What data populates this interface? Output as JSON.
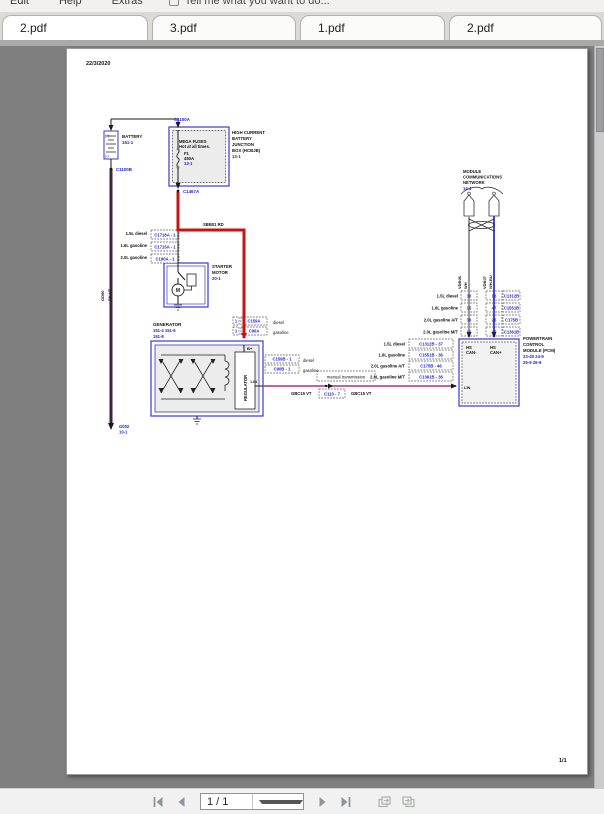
{
  "window": {
    "menu": {
      "items": [
        {
          "label": "Edit"
        },
        {
          "label": "Help"
        },
        {
          "label": "Extras"
        }
      ],
      "assistant_hint": "Tell me what you want to do..."
    },
    "tabs": [
      {
        "label": "2.pdf",
        "active": true
      },
      {
        "label": "3.pdf",
        "active": false
      },
      {
        "label": "1.pdf",
        "active": false
      },
      {
        "label": "2.pdf",
        "active": false
      }
    ],
    "statusbar": {
      "page_field": "1 / 1"
    }
  },
  "document": {
    "date": "22/3/2020",
    "sheet_number": "1/1"
  },
  "diagram": {
    "colors": {
      "component_border": "#3a3ac8",
      "connector_text": "#2121cc",
      "power_red": "#cc1111",
      "lin_violet": "#b0509d",
      "battery_negative": "#40233a",
      "can_plus_blue": "#4747cc",
      "can_minus_white": "#9a9a9a"
    },
    "labels": [
      {
        "n": "print-date",
        "t": "22/3/2020",
        "x": 19,
        "y": 16,
        "fs": 5.5,
        "b": 1
      },
      {
        "n": "sheet-number",
        "t": "1/1",
        "x": 492,
        "y": 713,
        "fs": 5.5,
        "b": 1
      },
      {
        "n": "battery-title",
        "t": "BATTERY",
        "x": 55,
        "y": 89,
        "fs": 4.4,
        "b": 1
      },
      {
        "n": "battery-ref",
        "t": "151-1",
        "x": 55,
        "y": 95,
        "fs": 4.4,
        "c": "b",
        "b": 1
      },
      {
        "n": "battery-plus",
        "t": "(+)",
        "x": 38,
        "y": 88,
        "fs": 3.6
      },
      {
        "n": "battery-minus",
        "t": "(-)",
        "x": 38,
        "y": 108,
        "fs": 3.6
      },
      {
        "n": "conn-c1100a",
        "t": "C1100A",
        "x": 107,
        "y": 72,
        "fs": 4.4,
        "c": "b",
        "b": 1
      },
      {
        "n": "conn-c1100b",
        "t": "C1100B",
        "x": 49,
        "y": 122,
        "fs": 4.4,
        "c": "b",
        "b": 1
      },
      {
        "n": "wire-name-gd90",
        "t": "GD90",
        "x": 37,
        "y": 252,
        "fs": 4,
        "r": -90,
        "b": 1
      },
      {
        "n": "wire-color-bkvt",
        "t": "BK-VT",
        "x": 44,
        "y": 252,
        "fs": 4,
        "r": -90,
        "b": 1
      },
      {
        "n": "ground-g002",
        "t": "G002",
        "x": 52,
        "y": 379,
        "fs": 4.2,
        "c": "b",
        "b": 1
      },
      {
        "n": "ground-g002-ref",
        "t": "10-1",
        "x": 52,
        "y": 384.5,
        "fs": 4.2,
        "c": "b",
        "b": 1
      },
      {
        "n": "megafuses-title",
        "t": "MEGA FUSES",
        "x": 112,
        "y": 94,
        "fs": 4.2,
        "b": 1
      },
      {
        "n": "megafuses-sub",
        "t": "Hot at all times.",
        "x": 112,
        "y": 99,
        "fs": 4.2,
        "b": 1
      },
      {
        "n": "fuse-name",
        "t": "F1",
        "x": 117,
        "y": 106,
        "fs": 4.2,
        "b": 1
      },
      {
        "n": "fuse-rating",
        "t": "450A",
        "x": 117,
        "y": 111,
        "fs": 4.2,
        "b": 1
      },
      {
        "n": "fuse-ref",
        "t": "13-1",
        "x": 117,
        "y": 116,
        "fs": 4.2,
        "c": "b",
        "b": 1
      },
      {
        "n": "hcbjb-title-1",
        "t": "HIGH CURRENT",
        "x": 165,
        "y": 85,
        "fs": 4.3,
        "b": 1
      },
      {
        "n": "hcbjb-title-2",
        "t": "BATTERY",
        "x": 165,
        "y": 91,
        "fs": 4.3,
        "b": 1
      },
      {
        "n": "hcbjb-title-3",
        "t": "JUNCTION",
        "x": 165,
        "y": 97,
        "fs": 4.3,
        "b": 1
      },
      {
        "n": "hcbjb-title-4",
        "t": "BOX (HCBJB)",
        "x": 165,
        "y": 103,
        "fs": 4.3,
        "b": 1
      },
      {
        "n": "hcbjb-ref",
        "t": "13-1",
        "x": 165,
        "y": 109,
        "fs": 4.3,
        "c": "b",
        "b": 1
      },
      {
        "n": "conn-c1467a",
        "t": "C1467A",
        "x": 116,
        "y": 144,
        "fs": 4.4,
        "c": "b",
        "b": 1
      },
      {
        "n": "wire-sbb01",
        "t": "SBB01  RD",
        "x": 136,
        "y": 177,
        "fs": 4.2,
        "b": 1
      },
      {
        "n": "variant-15l-diesel",
        "t": "1.5L diesel",
        "x": 80,
        "y": 186,
        "fs": 4.2,
        "a": "e",
        "b": 1
      },
      {
        "n": "variant-16l-gasoline",
        "t": "1.6L gasoline",
        "x": 80,
        "y": 198,
        "fs": 4.2,
        "a": "e",
        "b": 1
      },
      {
        "n": "variant-20l-gasoline",
        "t": "2.0L gasoline",
        "x": 80,
        "y": 210,
        "fs": 4.2,
        "a": "e",
        "b": 1
      },
      {
        "n": "starter-title-1",
        "t": "STARTER",
        "x": 145,
        "y": 219,
        "fs": 4.3,
        "b": 1
      },
      {
        "n": "starter-title-2",
        "t": "MOTOR",
        "x": 145,
        "y": 225,
        "fs": 4.3,
        "b": 1
      },
      {
        "n": "starter-ref",
        "t": "20-1",
        "x": 145,
        "y": 231,
        "fs": 4.3,
        "c": "b",
        "b": 1
      },
      {
        "n": "starter-motor-m",
        "t": "M",
        "x": 111,
        "y": 243,
        "fs": 5,
        "a": "m",
        "b": 1
      },
      {
        "n": "generator-title",
        "t": "GENERATOR",
        "x": 86,
        "y": 277,
        "fs": 4.5,
        "b": 1
      },
      {
        "n": "generator-ref-1",
        "t": "151-4  151-6",
        "x": 86,
        "y": 283,
        "fs": 4.2,
        "c": "b",
        "b": 1
      },
      {
        "n": "generator-ref-2",
        "t": "151-8",
        "x": 86,
        "y": 289,
        "fs": 4.2,
        "c": "b",
        "b": 1
      },
      {
        "n": "gen-bplus",
        "t": "B+",
        "x": 180,
        "y": 301,
        "fs": 4,
        "b": 1
      },
      {
        "n": "gen-regulator",
        "t": "REGULATOR",
        "x": 180,
        "y": 352,
        "fs": 4.2,
        "r": -90,
        "b": 1
      },
      {
        "n": "gen-lin",
        "t": "LIN",
        "x": 190,
        "y": 334,
        "fs": 4,
        "a": "e",
        "b": 1
      },
      {
        "n": "gen-top-diesel",
        "t": "diesel",
        "x": 206,
        "y": 275,
        "fs": 4.2
      },
      {
        "n": "gen-top-gasoline",
        "t": "gasoline",
        "x": 206,
        "y": 285,
        "fs": 4.2
      },
      {
        "n": "gen-right-diesel",
        "t": "diesel",
        "x": 236,
        "y": 313,
        "fs": 4.2
      },
      {
        "n": "gen-right-gasoline",
        "t": "gasoline",
        "x": 236,
        "y": 323,
        "fs": 4.2
      },
      {
        "n": "lin-wire-label-1",
        "t": "GBC15  VT",
        "x": 224,
        "y": 346,
        "fs": 4.2,
        "b": 1
      },
      {
        "n": "lin-wire-label-2",
        "t": "GBC15  VT",
        "x": 284,
        "y": 346,
        "fs": 4.2,
        "b": 1
      },
      {
        "n": "lin-variant-1",
        "t": "1.5L diesel",
        "x": 338,
        "y": 296.5,
        "fs": 4.2,
        "a": "e",
        "b": 1
      },
      {
        "n": "lin-variant-2",
        "t": "1.6L gasoline",
        "x": 338,
        "y": 307.5,
        "fs": 4.2,
        "a": "e",
        "b": 1
      },
      {
        "n": "lin-variant-3",
        "t": "2.0L gasoline A/T",
        "x": 338,
        "y": 318.5,
        "fs": 4.2,
        "a": "e",
        "b": 1
      },
      {
        "n": "lin-variant-4",
        "t": "2.0L gasoline M/T",
        "x": 338,
        "y": 329.5,
        "fs": 4.2,
        "a": "e",
        "b": 1
      },
      {
        "n": "pcm-lin",
        "t": "LIN",
        "x": 397,
        "y": 340,
        "fs": 4,
        "b": 1
      },
      {
        "n": "pcm-hs-1",
        "t": "HS",
        "x": 399,
        "y": 300,
        "fs": 4.2,
        "b": 1
      },
      {
        "n": "pcm-can-minus",
        "t": "CAN-",
        "x": 399,
        "y": 305,
        "fs": 4.2,
        "b": 1
      },
      {
        "n": "pcm-hs-2",
        "t": "HS",
        "x": 423,
        "y": 300,
        "fs": 4.2,
        "b": 1
      },
      {
        "n": "pcm-can-plus",
        "t": "CAN+",
        "x": 423,
        "y": 305,
        "fs": 4.2,
        "b": 1
      },
      {
        "n": "pcm-title-1",
        "t": "POWERTRAIN",
        "x": 456,
        "y": 291,
        "fs": 4.3,
        "b": 1
      },
      {
        "n": "pcm-title-2",
        "t": "CONTROL",
        "x": 456,
        "y": 297,
        "fs": 4.3,
        "b": 1
      },
      {
        "n": "pcm-title-3",
        "t": "MODULE (PCM)",
        "x": 456,
        "y": 303,
        "fs": 4.3,
        "b": 1
      },
      {
        "n": "pcm-ref-1",
        "t": "23-40  24-9",
        "x": 456,
        "y": 309,
        "fs": 4.3,
        "c": "b",
        "b": 1
      },
      {
        "n": "pcm-ref-2",
        "t": "25-9  26-9",
        "x": 456,
        "y": 315,
        "fs": 4.3,
        "c": "b",
        "b": 1
      },
      {
        "n": "pin-variant-1",
        "t": "1.5L diesel",
        "x": 391,
        "y": 248.5,
        "fs": 4.2,
        "a": "e",
        "b": 1
      },
      {
        "n": "pin-variant-2",
        "t": "1.6L gasoline",
        "x": 391,
        "y": 260.5,
        "fs": 4.2,
        "a": "e",
        "b": 1
      },
      {
        "n": "pin-variant-3",
        "t": "2.0L gasoline A/T",
        "x": 391,
        "y": 272.5,
        "fs": 4.2,
        "a": "e",
        "b": 1
      },
      {
        "n": "pin-variant-4",
        "t": "2.0L gasoline M/T",
        "x": 391,
        "y": 284.5,
        "fs": 4.2,
        "a": "e",
        "b": 1
      },
      {
        "n": "mcn-title-1",
        "t": "MODULE",
        "x": 396,
        "y": 124,
        "fs": 4.2,
        "b": 1
      },
      {
        "n": "mcn-title-2",
        "t": "COMMUNICATIONS",
        "x": 396,
        "y": 129.5,
        "fs": 4.2,
        "b": 1
      },
      {
        "n": "mcn-title-3",
        "t": "NETWORK",
        "x": 396,
        "y": 135,
        "fs": 4.2,
        "b": 1
      },
      {
        "n": "mcn-ref",
        "t": "14-4",
        "x": 396,
        "y": 141,
        "fs": 4.2,
        "c": "b",
        "b": 1
      },
      {
        "n": "can-wire-name-1",
        "t": "VDB06",
        "x": 394,
        "y": 240,
        "fs": 4,
        "r": -90,
        "b": 1
      },
      {
        "n": "can-wire-color-1",
        "t": "WH",
        "x": 400,
        "y": 240,
        "fs": 4,
        "r": -90,
        "b": 1
      },
      {
        "n": "can-wire-name-2",
        "t": "VDB07",
        "x": 419,
        "y": 240,
        "fs": 4,
        "r": -90,
        "b": 1
      },
      {
        "n": "can-wire-color-2",
        "t": "WH-BU",
        "x": 425,
        "y": 240,
        "fs": 4,
        "r": -90,
        "b": 1
      }
    ],
    "boxes": [
      {
        "n": "conn-c1716a",
        "x": 84,
        "y": 181,
        "w": 28,
        "h": 9,
        "t": "C1716A - 1"
      },
      {
        "n": "conn-c1715a",
        "x": 84,
        "y": 193,
        "w": 28,
        "h": 9,
        "t": "C1715A - 1"
      },
      {
        "n": "conn-c190a",
        "x": 84,
        "y": 205,
        "w": 28,
        "h": 9,
        "t": "C190A - 1"
      },
      {
        "n": "gen-top-pin-1",
        "x": 166,
        "y": 268,
        "w": 6,
        "h": 8,
        "t": "1"
      },
      {
        "n": "conn-c159a",
        "x": 174,
        "y": 268,
        "w": 26,
        "h": 8,
        "t": "C159A"
      },
      {
        "n": "gen-top-pin-2",
        "x": 166,
        "y": 278,
        "w": 6,
        "h": 8,
        "t": "1"
      },
      {
        "n": "conn-c90a",
        "x": 174,
        "y": 278,
        "w": 26,
        "h": 8,
        "t": "C90A"
      },
      {
        "n": "conn-c159b",
        "x": 198,
        "y": 306,
        "w": 34,
        "h": 8,
        "t": "C159B - 1"
      },
      {
        "n": "conn-c90b",
        "x": 198,
        "y": 316,
        "w": 34,
        "h": 8,
        "t": "C90B - 1"
      },
      {
        "n": "variant-manual-transmission",
        "x": 250,
        "y": 322,
        "w": 58,
        "h": 10,
        "t": "manual transmission",
        "tc": "k"
      },
      {
        "n": "conn-c110",
        "x": 252,
        "y": 340,
        "w": 26,
        "h": 9,
        "t": "C110 - 7"
      },
      {
        "n": "lin-conn-1",
        "x": 342,
        "y": 290,
        "w": 44,
        "h": 9,
        "t": "C1312B - 37"
      },
      {
        "n": "lin-conn-2",
        "x": 342,
        "y": 301,
        "w": 44,
        "h": 9,
        "t": "C1551B - 36"
      },
      {
        "n": "lin-conn-3",
        "x": 342,
        "y": 312,
        "w": 44,
        "h": 9,
        "t": "C175B - 46"
      },
      {
        "n": "lin-conn-4",
        "x": 342,
        "y": 323,
        "w": 44,
        "h": 9,
        "t": "C1361B - 36"
      },
      {
        "n": "can1-pin-1",
        "x": 394,
        "y": 242,
        "w": 16,
        "h": 9,
        "t": "30"
      },
      {
        "n": "can1-pin-2",
        "x": 394,
        "y": 254,
        "w": 16,
        "h": 9,
        "t": "15"
      },
      {
        "n": "can1-pin-3",
        "x": 394,
        "y": 266,
        "w": 16,
        "h": 9,
        "t": "36"
      },
      {
        "n": "can1-pin-4",
        "x": 394,
        "y": 278,
        "w": 16,
        "h": 9,
        "t": "15"
      },
      {
        "n": "can2-pin-1",
        "x": 419,
        "y": 242,
        "w": 16,
        "h": 9,
        "t": "16"
      },
      {
        "n": "can2-pin-2",
        "x": 419,
        "y": 254,
        "w": 16,
        "h": 9,
        "t": "47"
      },
      {
        "n": "can2-pin-3",
        "x": 419,
        "y": 266,
        "w": 16,
        "h": 9,
        "t": "26"
      },
      {
        "n": "can2-pin-4",
        "x": 419,
        "y": 278,
        "w": 16,
        "h": 9,
        "t": "47"
      },
      {
        "n": "pcm-conn-1",
        "x": 436,
        "y": 242,
        "w": 17,
        "h": 9,
        "t": "C1312B"
      },
      {
        "n": "pcm-conn-2",
        "x": 436,
        "y": 254,
        "w": 17,
        "h": 9,
        "t": "C1551B"
      },
      {
        "n": "pcm-conn-3",
        "x": 436,
        "y": 266,
        "w": 17,
        "h": 9,
        "t": "C175B"
      },
      {
        "n": "pcm-conn-4",
        "x": 436,
        "y": 278,
        "w": 17,
        "h": 9,
        "t": "C1361B"
      }
    ]
  }
}
